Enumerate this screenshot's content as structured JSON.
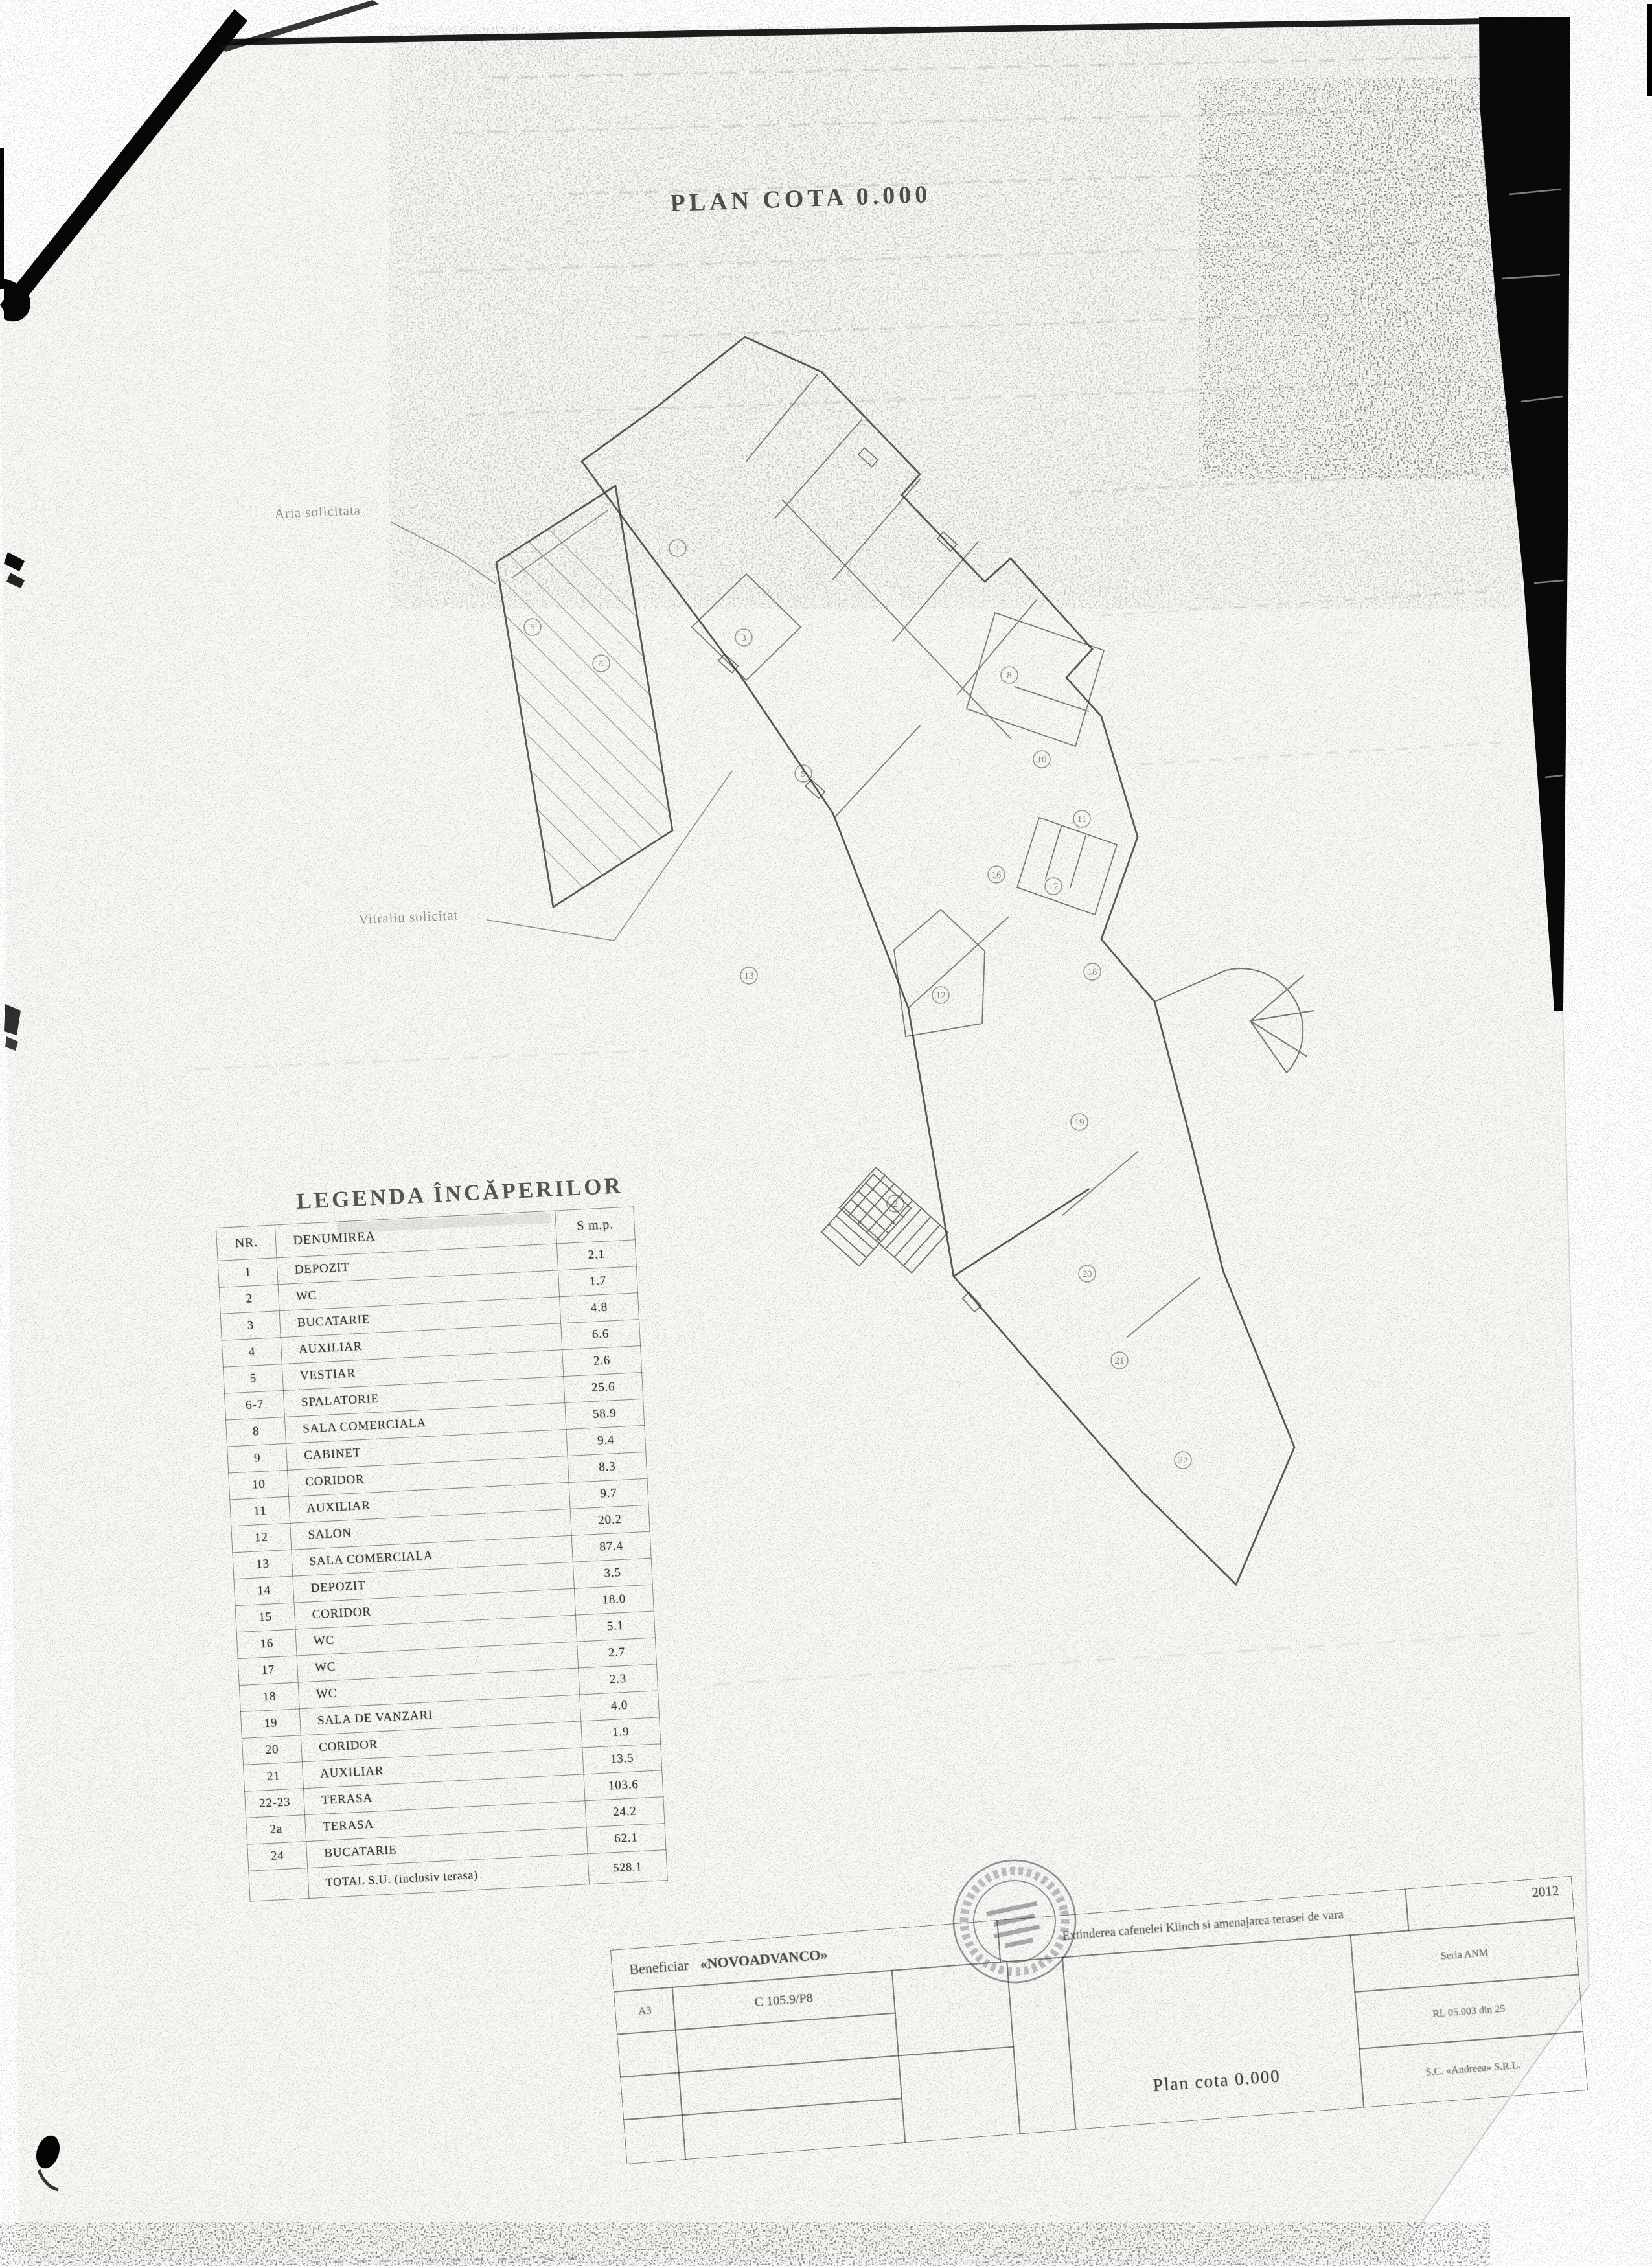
{
  "page": {
    "title": "PLAN COTA 0.000",
    "kind": "scanned architectural drawing"
  },
  "annotations": {
    "area_label": "Aria solicitata",
    "window_label": "Vitraliu solicitat"
  },
  "legend": {
    "heading": "LEGENDA ÎNCĂPERILOR",
    "columns": {
      "nr": "NR.",
      "name": "DENUMIREA",
      "area": "S m.p."
    },
    "rows": [
      {
        "nr": "1",
        "name": "DEPOZIT",
        "area": "2.1"
      },
      {
        "nr": "2",
        "name": "WC",
        "area": "1.7"
      },
      {
        "nr": "3",
        "name": "BUCATARIE",
        "area": "4.8"
      },
      {
        "nr": "4",
        "name": "AUXILIAR",
        "area": "6.6"
      },
      {
        "nr": "5",
        "name": "VESTIAR",
        "area": "2.6"
      },
      {
        "nr": "6-7",
        "name": "SPALATORIE",
        "area": "25.6"
      },
      {
        "nr": "8",
        "name": "SALA COMERCIALA",
        "area": "58.9"
      },
      {
        "nr": "9",
        "name": "CABINET",
        "area": "9.4"
      },
      {
        "nr": "10",
        "name": "CORIDOR",
        "area": "8.3"
      },
      {
        "nr": "11",
        "name": "AUXILIAR",
        "area": "9.7"
      },
      {
        "nr": "12",
        "name": "SALON",
        "area": "20.2"
      },
      {
        "nr": "13",
        "name": "SALA COMERCIALA",
        "area": "87.4"
      },
      {
        "nr": "14",
        "name": "DEPOZIT",
        "area": "3.5"
      },
      {
        "nr": "15",
        "name": "CORIDOR",
        "area": "18.0"
      },
      {
        "nr": "16",
        "name": "WC",
        "area": "5.1"
      },
      {
        "nr": "17",
        "name": "WC",
        "area": "2.7"
      },
      {
        "nr": "18",
        "name": "WC",
        "area": "2.3"
      },
      {
        "nr": "19",
        "name": "SALA DE VANZARI",
        "area": "4.0"
      },
      {
        "nr": "20",
        "name": "CORIDOR",
        "area": "1.9"
      },
      {
        "nr": "21",
        "name": "AUXILIAR",
        "area": "13.5"
      },
      {
        "nr": "22-23",
        "name": "TERASA",
        "area": "103.6"
      },
      {
        "nr": "2a",
        "name": "TERASA",
        "area": "24.2"
      },
      {
        "nr": "24",
        "name": "BUCATARIE",
        "area": "62.1"
      }
    ],
    "total": {
      "nr": "",
      "label": "TOTAL S.U. (inclusiv terasa)",
      "value": "528.1"
    }
  },
  "title_block": {
    "beneficiary_label": "Beneficiar",
    "beneficiary_name": "«NOVOADVANCO»",
    "project": "Extinderea cafenelei Klinch si amenajarea terasei de vara",
    "year": "2012",
    "format": "A3",
    "sheet_code": "C 105.9/P8",
    "drawing_title": "Plan cota 0.000",
    "series": "Seria ANM",
    "license": "RL 05.003 din 25",
    "firm": "S.C. «Andreea» S.R.L."
  },
  "plan": {
    "room_markers": [
      "1",
      "5",
      "4",
      "3",
      "9",
      "8",
      "10",
      "11",
      "16",
      "17",
      "18",
      "13",
      "12",
      "2",
      "19",
      "20",
      "21",
      "22"
    ]
  },
  "colors": {
    "paper": "#f8f8f5",
    "ink": "#32302c",
    "artifact_black": "#080808",
    "table_line": "#3a3a3a"
  }
}
